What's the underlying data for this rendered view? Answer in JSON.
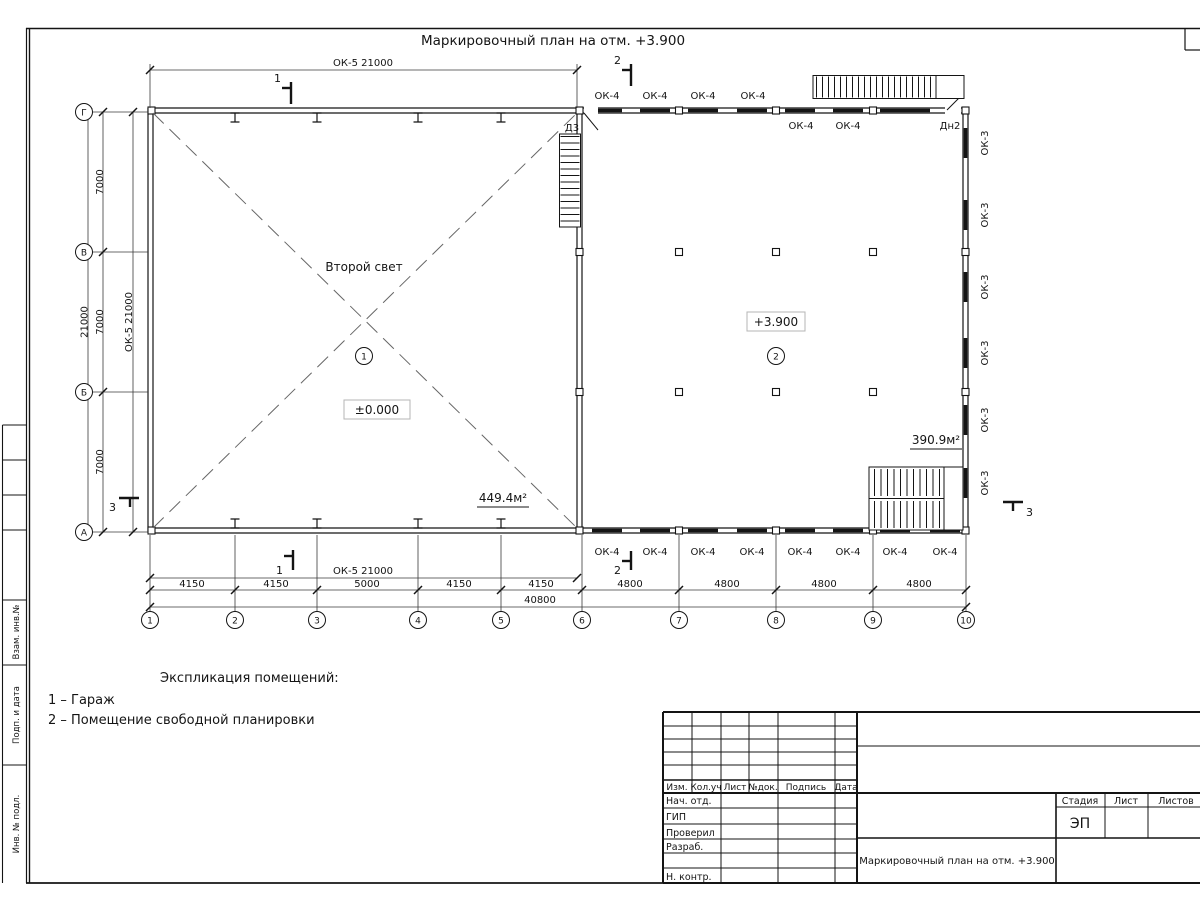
{
  "sheet": {
    "plan_title": "Маркировочный план на отм. +3.900"
  },
  "plan": {
    "room1": {
      "number": "1",
      "void_label": "Второй свет",
      "level": "±0.000",
      "area": "449.4м²"
    },
    "room2": {
      "number": "2",
      "level": "+3.900",
      "area": "390.9м²"
    },
    "axes_bottom": [
      "1",
      "2",
      "3",
      "4",
      "5",
      "6",
      "7",
      "8",
      "9",
      "10"
    ],
    "axes_left": [
      "Г",
      "В",
      "Б",
      "А"
    ],
    "dims_bottom": [
      "4150",
      "4150",
      "5000",
      "4150",
      "4150",
      "4800",
      "4800",
      "4800",
      "4800"
    ],
    "dim_total_bottom": "40800",
    "dim_ok5": "ОК-5 21000",
    "dims_left": [
      "7000",
      "7000",
      "7000"
    ],
    "dim_total_left": "21000",
    "window_ok4": "ОК-4",
    "window_ok3": "ОК-3",
    "door_d3": "Д3",
    "door_dn2": "Дн2",
    "section1": "1",
    "section2": "2",
    "section3": "3"
  },
  "legend": {
    "title": "Экспликация помещений:",
    "item1": "1 – Гараж",
    "item2": "2 – Помещение свободной планировки"
  },
  "titleblock": {
    "header_cols": [
      "Изм.",
      "Кол.уч",
      "Лист",
      "№док.",
      "Подпись",
      "Дата"
    ],
    "rows": [
      "Нач. отд.",
      "ГИП",
      "Проверил",
      "Разраб.",
      "Н. контр."
    ],
    "doc_title": "Маркировочный план на отм. +3.900",
    "stage_headers": [
      "Стадия",
      "Лист",
      "Листов"
    ],
    "stage_value": "ЭП"
  },
  "frame": {
    "side_labels": [
      "Взам. инв.№",
      "Подп. и дата",
      "Инв. № подл."
    ]
  }
}
